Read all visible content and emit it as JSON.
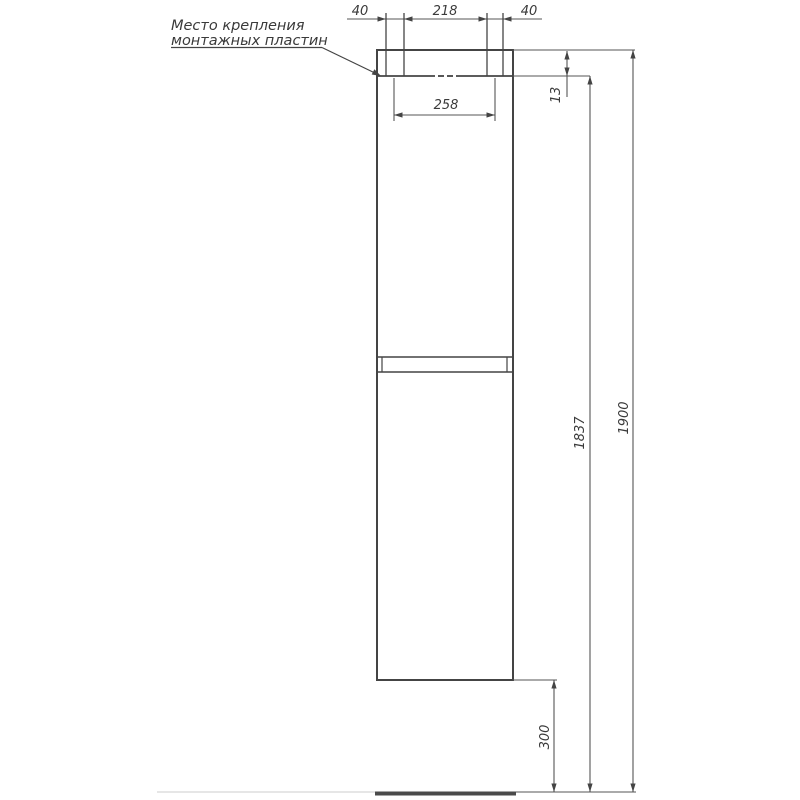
{
  "drawing": {
    "title_hint": "cabinet-front-elevation",
    "callout": {
      "line1": "Место крепления",
      "line2": "монтажных пластин"
    },
    "dims": {
      "top_left_40": "40",
      "top_218": "218",
      "top_right_40": "40",
      "plate_258": "258",
      "top_offset_13": "13",
      "body_1837": "1837",
      "total_1900": "1900",
      "bottom_300": "300"
    },
    "colors": {
      "line": "#444444",
      "dim": "#555555",
      "text": "#3a3a3a",
      "faint": "#d6d6d6",
      "floor": "#4a4a4a",
      "bg": "#ffffff"
    }
  }
}
